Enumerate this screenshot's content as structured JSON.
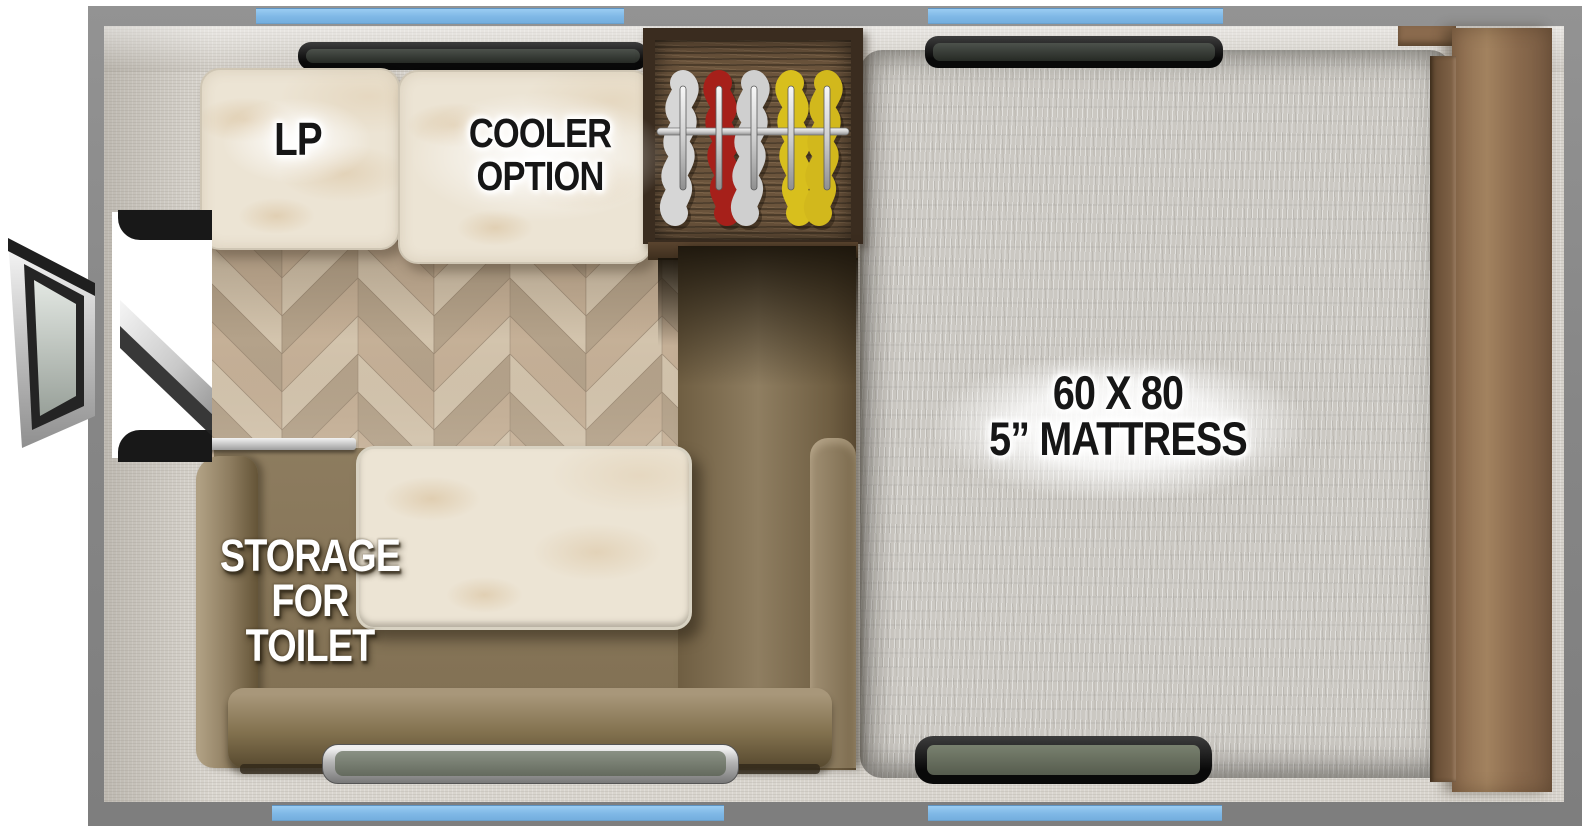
{
  "floorplan": {
    "labels": {
      "lp": "LP",
      "cooler_line1": "COOLER",
      "cooler_line2": "OPTION",
      "mattress_line1": "60 X 80",
      "mattress_line2": "5” MATTRESS",
      "storage_line1": "STORAGE",
      "storage_line2": "FOR",
      "storage_line3": "TOILET"
    },
    "colors": {
      "frame_gray": "#868686",
      "window_blue": "#7fb8e6",
      "wall": "#d9d5ce",
      "mattress_fabric": "#cbc8c2",
      "sofa_tan": "#8d7c5f",
      "marble_counter": "#ece4d4",
      "floor_wood": "#c5b097",
      "closet_wood": "#6b543c",
      "headboard_wood": "#8a6a4d",
      "clothes_white": "#d8d8d8",
      "clothes_red": "#a6201a",
      "clothes_yellow": "#d8bf1d"
    }
  }
}
